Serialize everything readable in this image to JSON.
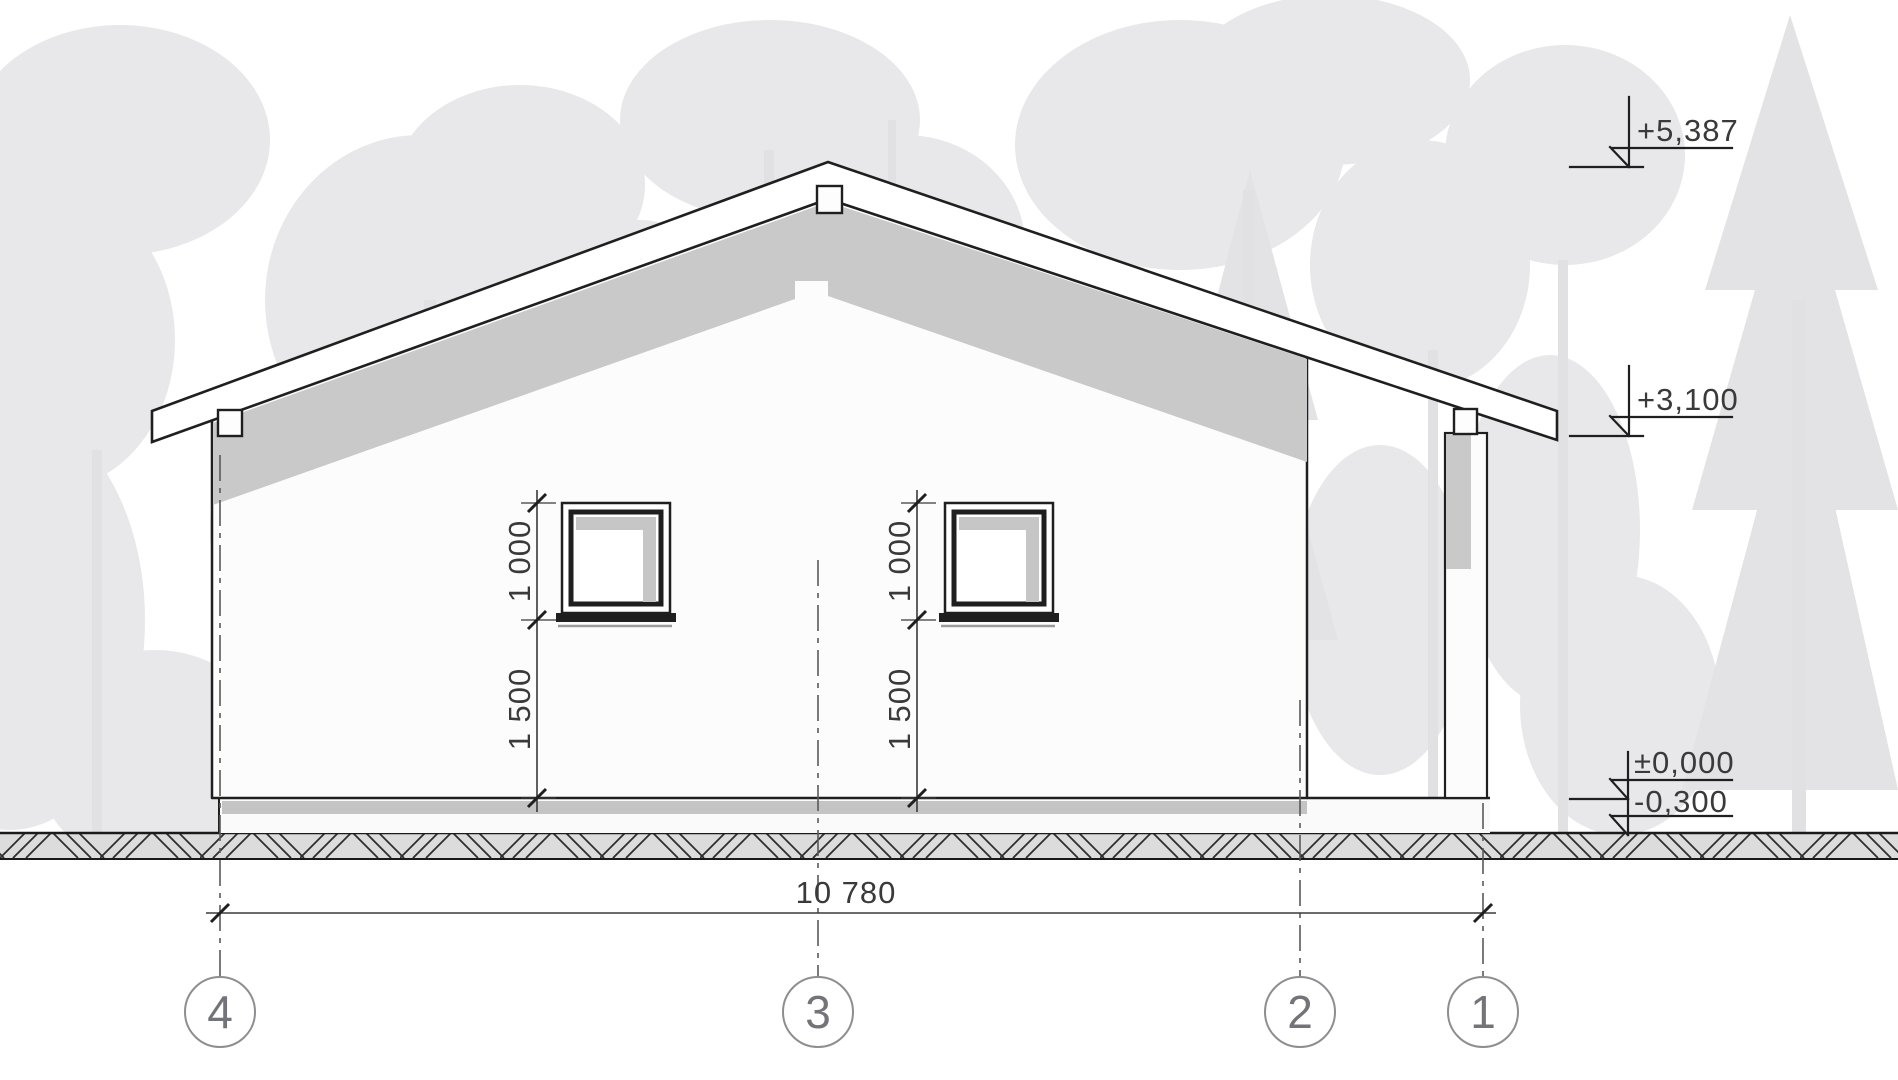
{
  "drawing_type": "house-gable-end-elevation",
  "levels": {
    "ridge": "+5,387",
    "eaves": "+3,100",
    "floor": "±0,000",
    "ground": "-0,300"
  },
  "dims": {
    "window_height": "1 000",
    "sill_height": "1 500",
    "overall_width": "10 780"
  },
  "axes": [
    {
      "label": "4"
    },
    {
      "label": "3"
    },
    {
      "label": "2"
    },
    {
      "label": "1"
    }
  ],
  "palette": {
    "line": "#1f1f1f",
    "dim_line": "#3a3a3a",
    "shadow_gray": "#c9c9c9",
    "plinth_gray": "#c4c4c4",
    "ground_fill": "#dcdcdc",
    "forest_gray": "#e8e8eb",
    "axis_circle": "#8e8e92",
    "axis_number": "#73737a"
  }
}
